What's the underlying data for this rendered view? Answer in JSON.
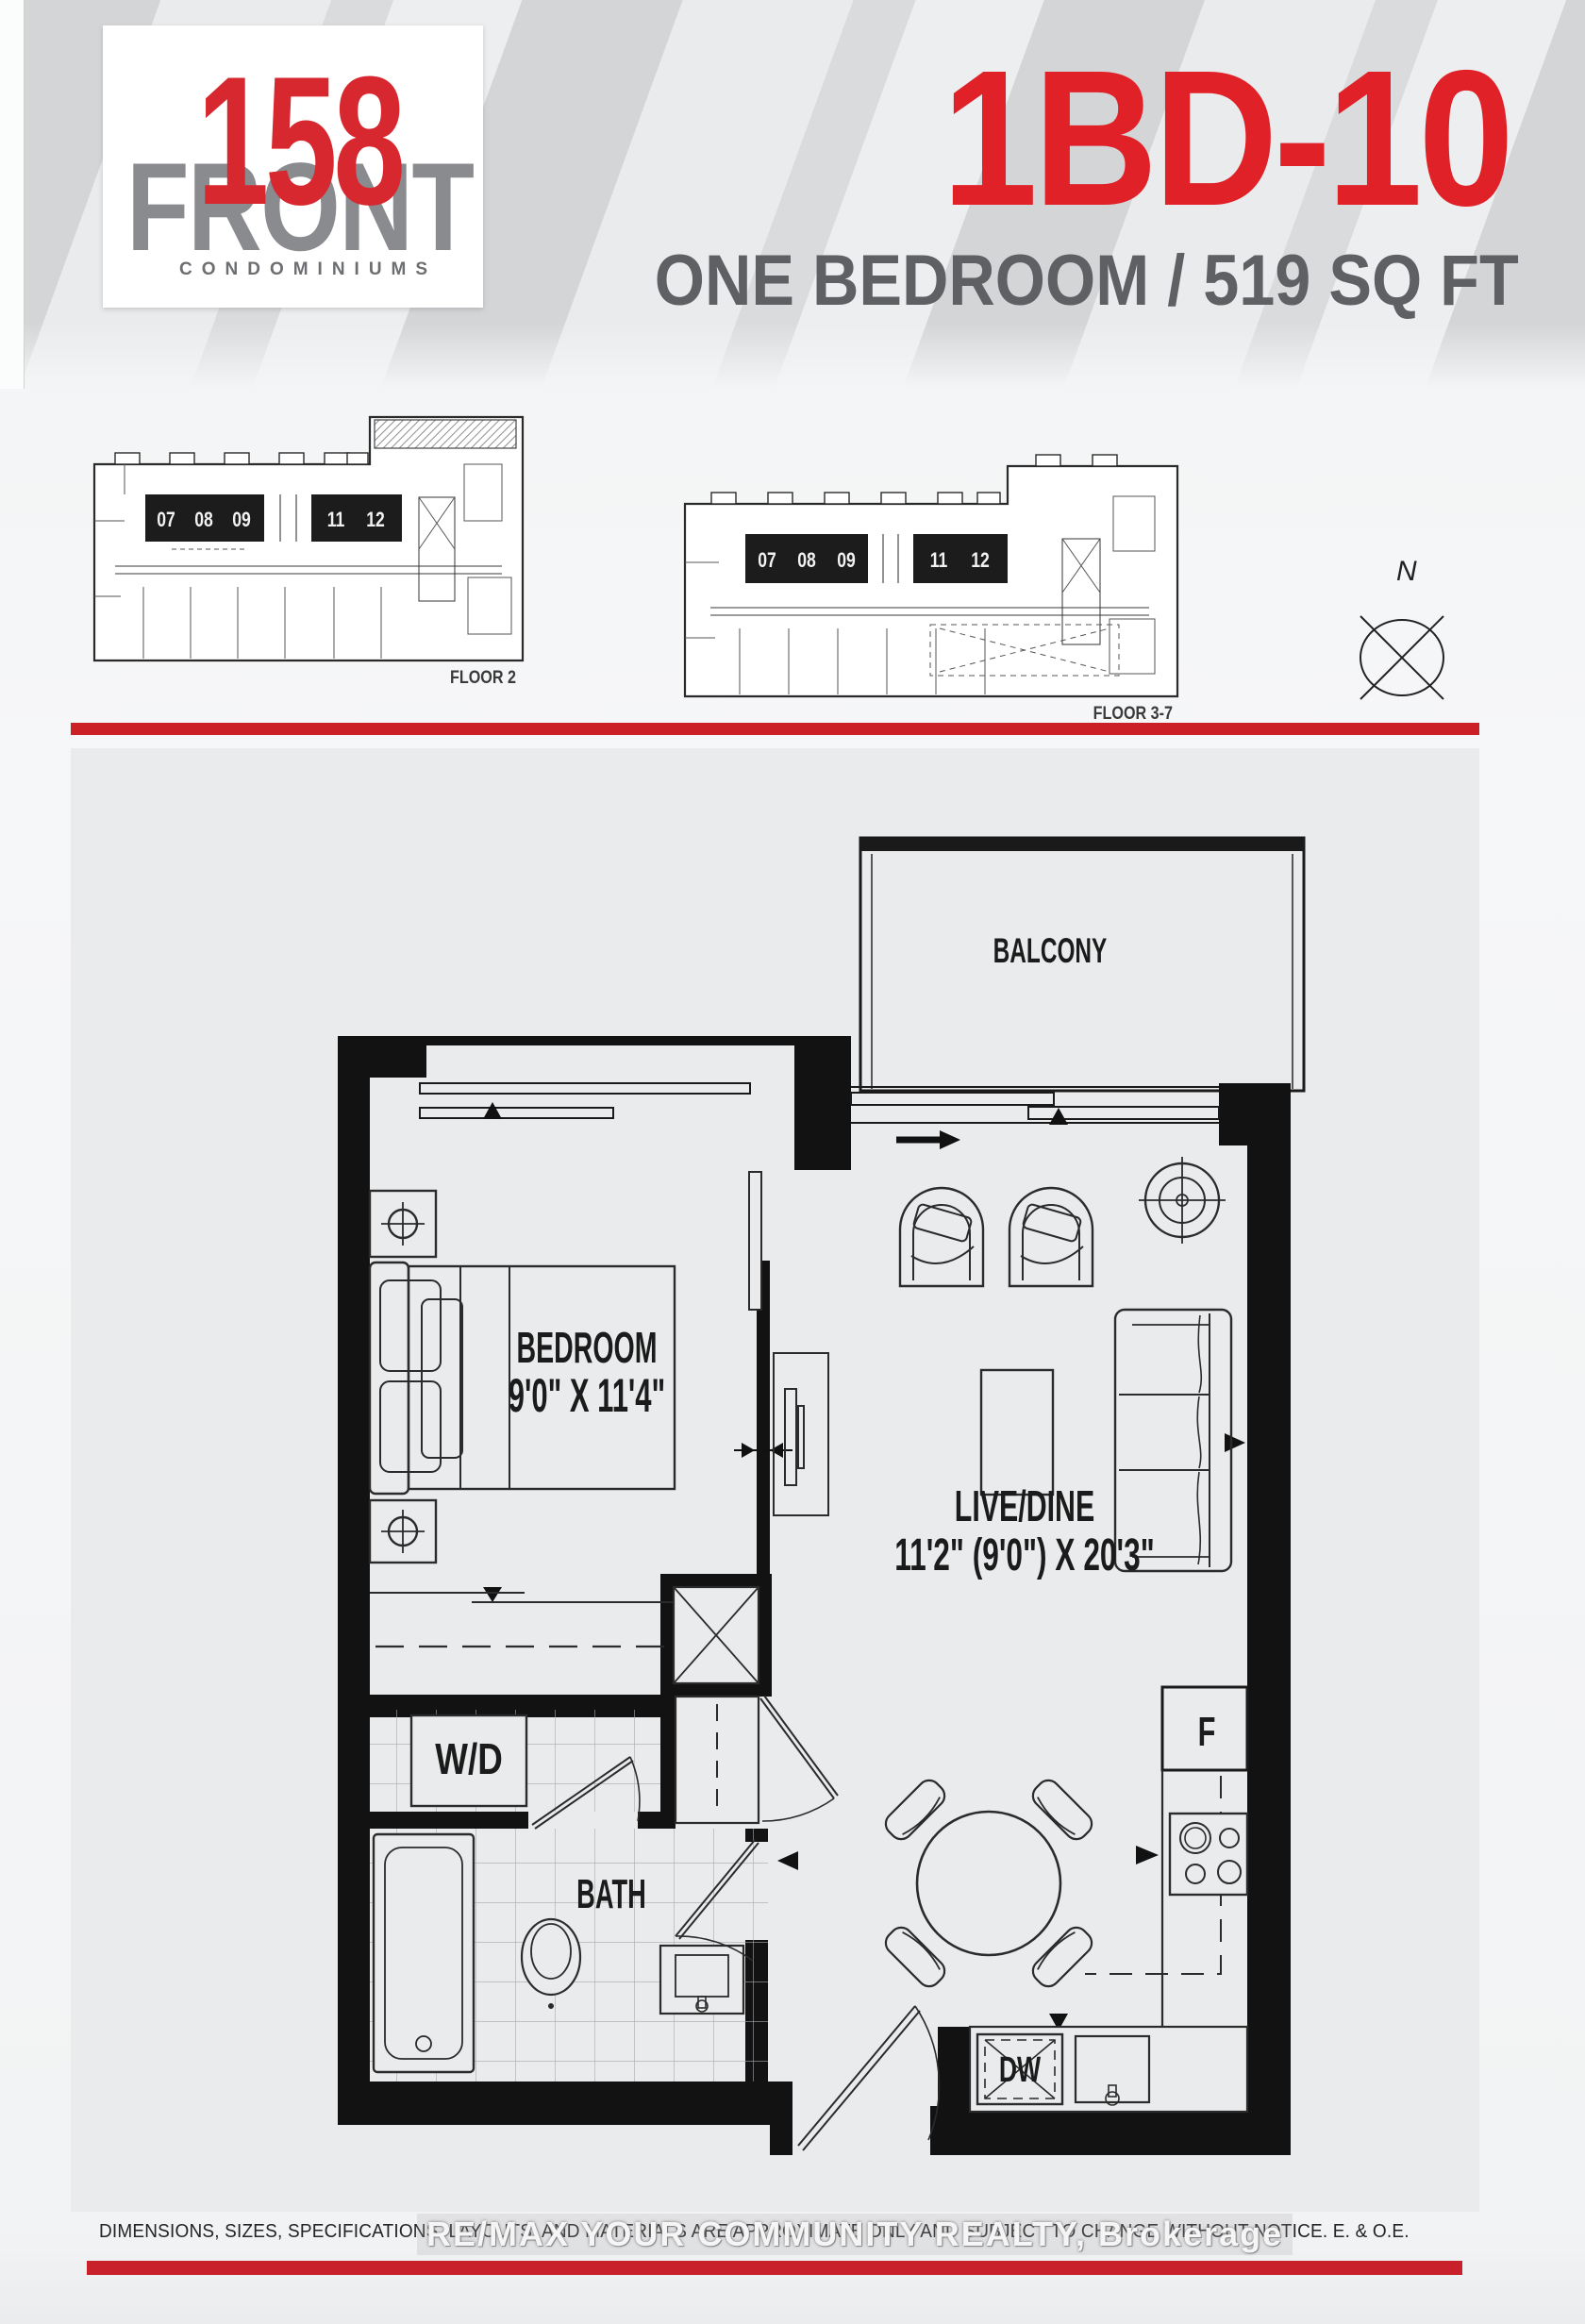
{
  "header": {
    "logo": {
      "number": "158",
      "name": "FRONT",
      "tagline": "CONDOMINIUMS"
    },
    "plan_code": "1BD-10",
    "plan_subtitle": "ONE BEDROOM / 519 SQ FT"
  },
  "key_plans": [
    {
      "label": "FLOOR 2",
      "units": [
        "07",
        "08",
        "09",
        "11",
        "12"
      ]
    },
    {
      "label": "FLOOR 3-7",
      "units": [
        "07",
        "08",
        "09",
        "11",
        "12"
      ]
    }
  ],
  "compass": {
    "label": "N"
  },
  "floor_plan": {
    "balcony": "BALCONY",
    "bedroom": {
      "name": "BEDROOM",
      "dims": "9'0\" X 11'4\""
    },
    "live_dine": {
      "name": "LIVE/DINE",
      "dims": "11'2\" (9'0\") X 20'3\""
    },
    "bath": "BATH",
    "laundry": "W/D",
    "fridge": "F",
    "dishwasher": "DW"
  },
  "footer": {
    "disclaimer": "DIMENSIONS, SIZES, SPECIFICATIONS, LAYOUTS, AND MATERIALS ARE APPROXIMATE ONLY AND SUBJECT TO CHANGE WITHOUT NOTICE. E. & O.E.",
    "watermark": "RE/MAX YOUR COMMUNITY REALTY, Brokerage"
  },
  "colors": {
    "accent_red": "#e02128",
    "bar_red": "#c9212b",
    "logo_red": "#d7282f",
    "logo_gray": "#898b8e",
    "text_gray": "#5e6063"
  }
}
